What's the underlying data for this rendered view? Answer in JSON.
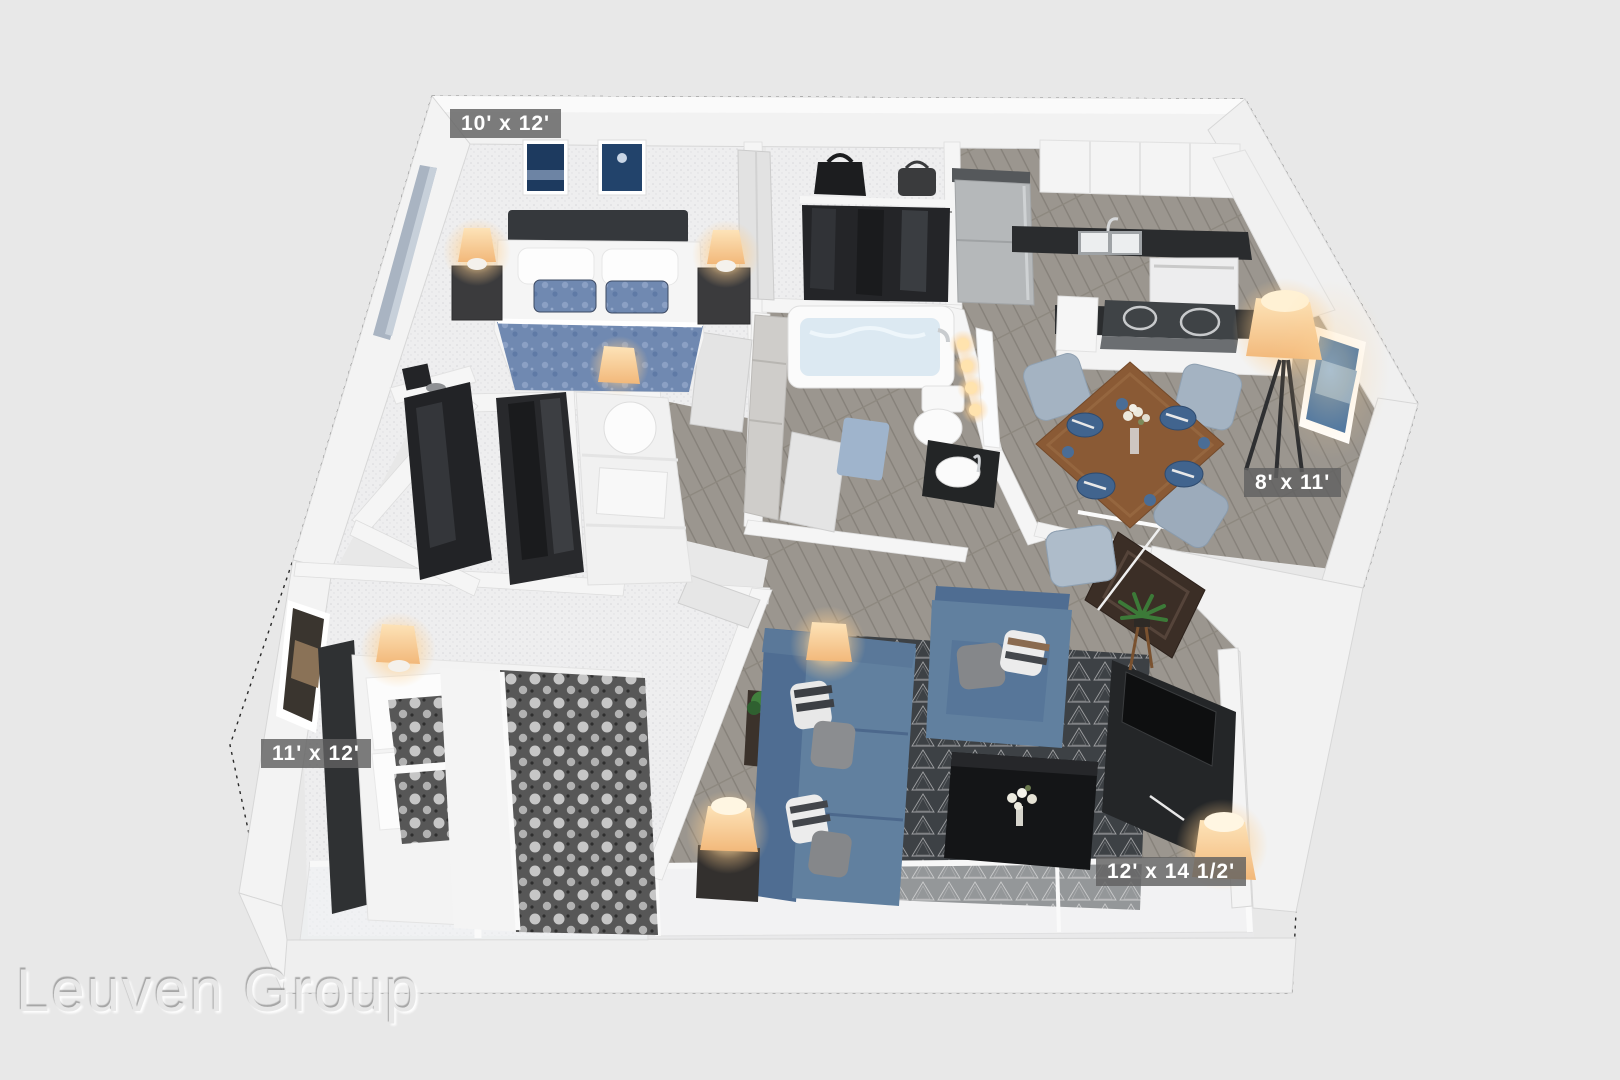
{
  "watermark": {
    "text": "Leuven Group"
  },
  "floorplan": {
    "dimension_labels": [
      {
        "room": "bedroom-upper",
        "text": "10' x 12'"
      },
      {
        "room": "dining",
        "text": "8' x 11'"
      },
      {
        "room": "bedroom-lower",
        "text": "11' x 12'"
      },
      {
        "room": "living",
        "text": "12' x 14 1/2'"
      }
    ]
  },
  "colors": {
    "background": "#e8e8e8",
    "wall": "#f3f3f3",
    "wood_floor": "#9b968f",
    "carpet": "#eeeeef",
    "rug_dark": "#3d4145",
    "sofa_blue": "#61809f",
    "duvet_blue": "#7089b1",
    "counter_black": "#2a2c2e",
    "table_wood": "#8a5a35",
    "lamp_glow": "#ffd9a0",
    "label_bg": "rgba(96,96,96,0.82)",
    "label_text": "#ffffff"
  }
}
